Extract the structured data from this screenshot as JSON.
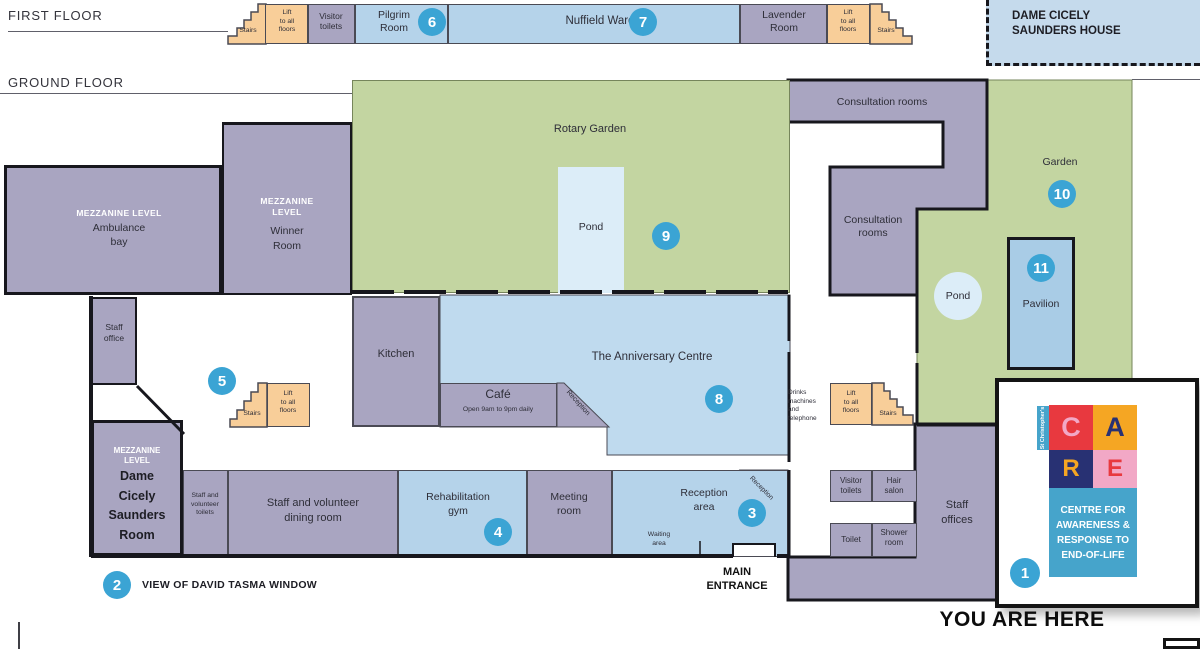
{
  "titles": {
    "first_floor": "FIRST FLOOR",
    "ground_floor": "GROUND FLOOR",
    "house": "DAME CICELY\nSAUNDERS HOUSE",
    "you_are_here": "YOU ARE HERE"
  },
  "first_floor": {
    "stairs": "Stairs",
    "lift": "Lift\nto all\nfloors",
    "visitor_toilets": "Visitor\ntoilets",
    "pilgrim": "Pilgrim\nRoom",
    "num6": "6",
    "nuffield": "Nuffield Ward",
    "num7": "7",
    "lavender": "Lavender\nRoom"
  },
  "ground": {
    "rotary_garden": "Rotary Garden",
    "pond_a": "Pond",
    "num9": "9",
    "consultation_top": "Consultation rooms",
    "consultation_side": "Consultation\nrooms",
    "garden": "Garden",
    "num10": "10",
    "pond_b": "Pond",
    "pavilion": "Pavilion",
    "num11": "11",
    "mezz_line": "MEZZANINE LEVEL",
    "mezz_two": "MEZZANINE\nLEVEL",
    "ambulance": "Ambulance\nbay",
    "winner": "Winner\nRoom",
    "staff_office": "Staff\noffice",
    "num5": "5",
    "stairs": "Stairs",
    "lift": "Lift\nto all\nfloors",
    "kitchen": "Kitchen",
    "cafe": "Café",
    "cafe_hours": "Open 9am to 9pm daily",
    "reception": "Reception",
    "anniversary": "The Anniversary Centre",
    "num8": "8",
    "drinks": "Drinks\nmachines\nand\ntelephone",
    "dame_room": "Dame\nCicely\nSaunders\nRoom",
    "sv_toilets": "Staff and\nvolunteer\ntoilets",
    "dining": "Staff and volunteer\ndining room",
    "rehab": "Rehabilitation\ngym",
    "num4": "4",
    "meeting": "Meeting\nroom",
    "reception_area": "Reception\narea",
    "num3": "3",
    "waiting": "Waiting\narea",
    "main_entrance": "MAIN\nENTRANCE",
    "visitor_toilets": "Visitor\ntoilets",
    "hair_salon": "Hair\nsalon",
    "toilet": "Toilet",
    "shower": "Shower\nroom",
    "staff_offices": "Staff\noffices"
  },
  "annotations": {
    "num1": "1",
    "num2": "2",
    "tasma": "VIEW OF DAVID TASMA WINDOW"
  },
  "care": {
    "side": "St Christopher's",
    "c": "C",
    "a": "A",
    "r": "R",
    "e": "E",
    "tagline": "CENTRE FOR\nAWARENESS &\nRESPONSE TO\nEND-OF-LIFE"
  },
  "palette": {
    "room_purple": "#A9A5C1",
    "room_blue": "#B5D3EA",
    "room_green": "#C3D5A1",
    "room_orange": "#F8CE99",
    "pond_blue": "#DCEDF8",
    "circle_blue": "#3BA4D4",
    "care_red": "#E8393F",
    "care_orange": "#F5A623",
    "care_navy": "#283173",
    "care_pink": "#F2A8C6",
    "care_blue": "#46A4CB"
  }
}
